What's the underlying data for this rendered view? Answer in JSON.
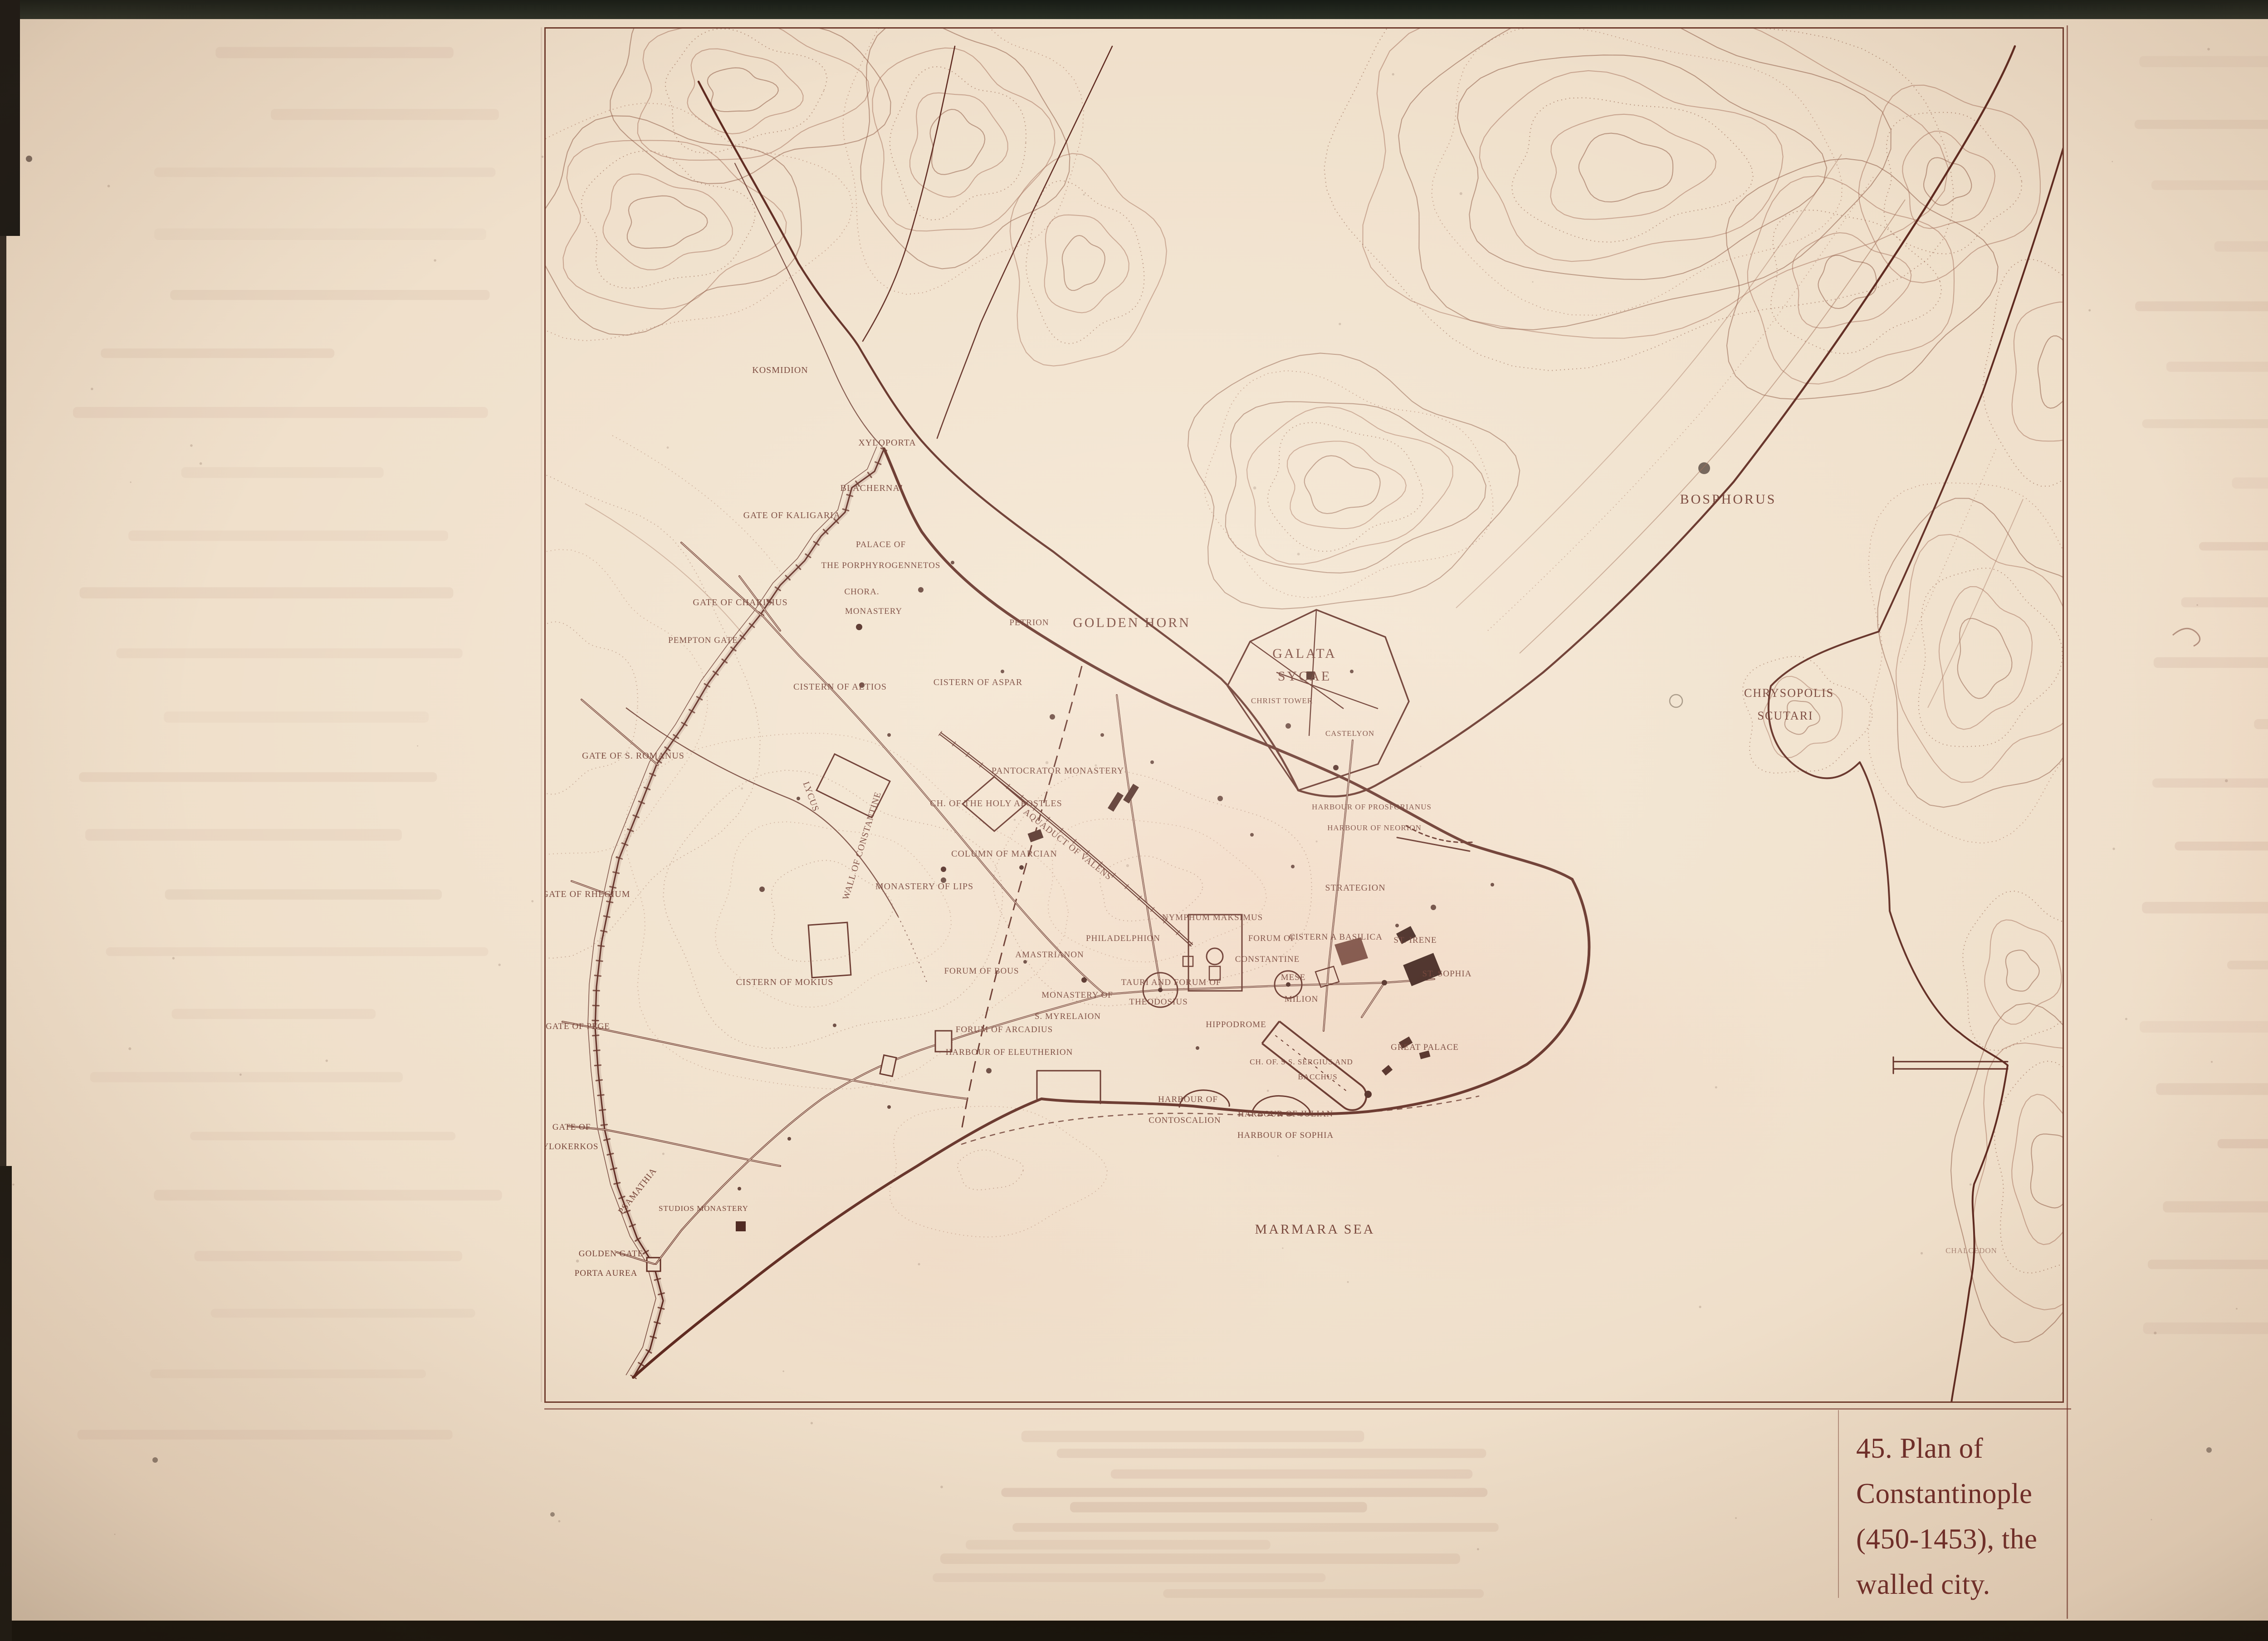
{
  "caption": {
    "line1": "45. Plan of",
    "line2": "Constantinople",
    "line3": "(450-1453), the",
    "line4": "walled city."
  },
  "colors": {
    "ink": "#5e2a22",
    "paper": "#f0e0cc",
    "caption_text": "#6e2c28"
  },
  "map": {
    "labels": {
      "kosmidion": "KOSMIDION",
      "xyloporta": "XYLOPORTA",
      "blachernai": "BLACHERNAI",
      "gate_of_kaligaria": "GATE OF KALIGARIA",
      "palace_line1": "PALACE OF",
      "palace_line2": "THE PORPHYROGENNETOS",
      "chora": "CHORA.",
      "chora_monastery": "MONASTERY",
      "gate_of_charisius": "GATE OF CHARISIUS",
      "pempton_gate": "PEMPTON GATE",
      "petrion": "PETRION",
      "golden_horn": "GOLDEN HORN",
      "cistern_of_aetios": "CISTERN OF AETIOS",
      "cistern_of_aspar": "CISTERN OF ASPAR",
      "galata": "GALATA",
      "sycae": "SYCAE",
      "christ_tower": "CHRIST TOWER",
      "castelyon": "CASTELYON",
      "bosphorus": "BOSPHORUS",
      "chrysopolis": "CHRYSOPOLIS",
      "scutari": "SCUTARI",
      "gate_of_s_romanus": "GATE OF S. ROMANUS",
      "lycus": "LYCUS",
      "wall_of_constantine": "WALL OF CONSTANTINE",
      "pantocrator_monastery": "PANTOCRATOR  MONASTERY",
      "holy_apostles": "CH. OF THE HOLY APOSTLES",
      "column_of_marcian": "COLUMN OF MARCIAN",
      "monastery_of_lips": "MONASTERY OF LIPS",
      "gate_of_rhegium": "GATE OF RHEGIUM",
      "aquaduct_of_valens": "AQUADUCT OF VALENS",
      "nymphum_maksimus": "NYMPHUM MAKSIMUS",
      "strategion": "STRATEGION",
      "harbour_prosforianus": "HARBOUR OF PROSFORIANUS",
      "harbour_neorion": "HARBOUR OF NEORION",
      "philadelphion": "PHILADELPHION",
      "amastrianon": "AMASTRIANON",
      "forum_of_bous": "FORUM OF BOUS",
      "forum_of_arcadius": "FORUM OF ARCADIUS",
      "forum_of_constantine_1": "FORUM OF",
      "forum_of_constantine_2": "CONSTANTINE",
      "cisterna_basilica": "CISTERN A  BASILICA",
      "st_irene": "ST. IRENE",
      "st_sophia": "ST. SOPHIA",
      "mese": "MESE",
      "milion": "MILION",
      "tauri_1": "TAURI AND FORUM OF",
      "tauri_2": "THEODOSIUS",
      "myrelaion_1": "MONASTERY OF",
      "myrelaion_2": "S. MYRELAION",
      "hippodrome": "HIPPODROME",
      "great_palace": "GREAT PALACE",
      "sergius_1": "CH. OF. S S. SERGIUS AND",
      "sergius_2": "BACCHUS",
      "cistern_of_mokius": "CISTERN OF MOKIUS",
      "gate_of_pege": "GATE OF PEGE",
      "harbour_eleutherion": "HARBOUR OF ELEUTHERION",
      "harbour_contoscalion_1": "HARBOUR OF",
      "harbour_contoscalion_2": "CONTOSCALION",
      "harbour_julian": "HARBOUR OF JULIAN",
      "harbour_sophia": "HARBOUR OF SOPHIA",
      "gate_xylokerkos_1": "GATE OF",
      "gate_xylokerkos_2": "XYLOKERKOS",
      "psamathia": "PSAMATHIA",
      "studios_monastery": "STUDIOS  MONASTERY",
      "golden_gate_1": "GOLDEN  GATE",
      "golden_gate_2": "PORTA AUREA",
      "marmara_sea": "MARMARA SEA",
      "chalcedon": "CHALCEDON"
    }
  }
}
